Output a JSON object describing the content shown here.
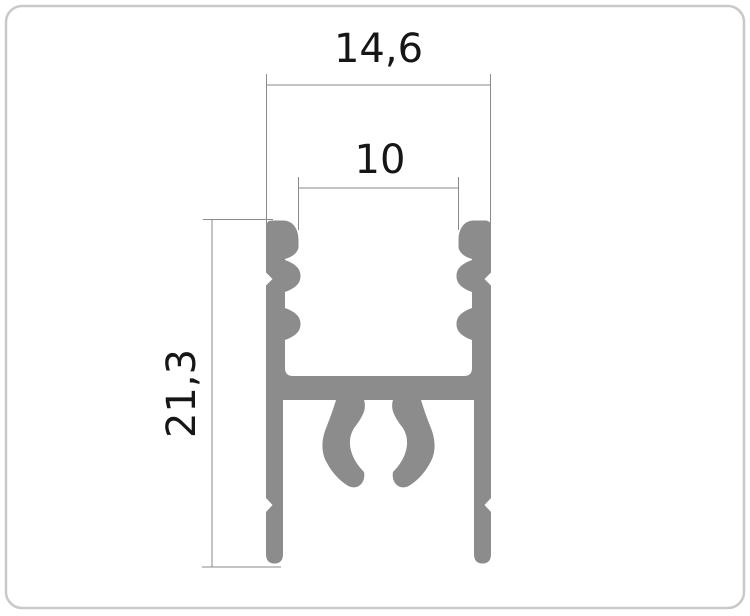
{
  "diagram": {
    "kind": "aluminium-profile-cross-section",
    "dimensions": {
      "outer_width": {
        "label": "14,6"
      },
      "opening_width": {
        "label": "10"
      },
      "height": {
        "label": "21,3"
      }
    },
    "colors": {
      "profile_fill": "#8c8c8c",
      "dimension_line": "#8a8a8a",
      "label_text": "#161616",
      "frame_border": "#c9c9c9",
      "background": "#ffffff"
    }
  }
}
